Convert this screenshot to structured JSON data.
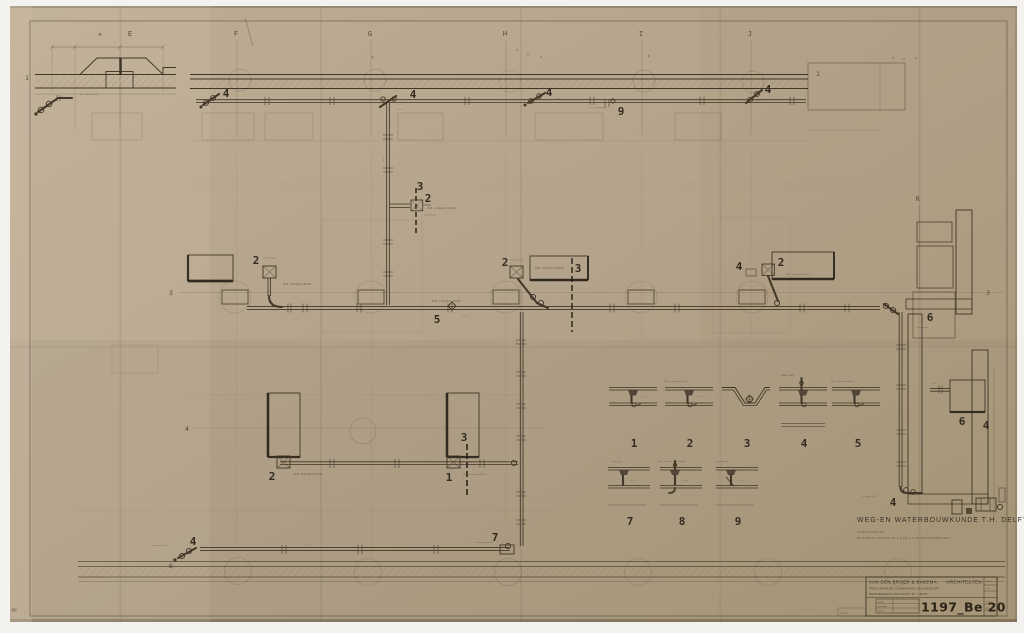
{
  "grid": {
    "letters": [
      "e",
      "E",
      "F",
      "G",
      "H",
      "I",
      "J"
    ],
    "letter_k": "K",
    "markers": {
      "top_left": "1",
      "top_right": "1",
      "row3_left": "3",
      "row3_right": "3",
      "row4_left": "4",
      "row6_left": "6"
    }
  },
  "callouts": {
    "one": "1",
    "two": "2",
    "three": "3",
    "four": "4",
    "five": "5",
    "six": "6",
    "seven": "7",
    "nine": "9"
  },
  "annotations": {
    "schrobput": "W.B. schrobput 30x30",
    "doucheput": "doucheput",
    "afv_asbest": "afv. asbest ø 100",
    "afv_geul": "afv. geul ø 100",
    "omlegging": "ø 75 omlegging",
    "ontstop": "met ontstopstuk",
    "afv_goot": "afv. goot ø 70",
    "dia70": "ø 70",
    "dia75": "ø 75"
  },
  "details_row1": [
    {
      "no": "1",
      "caption": ""
    },
    {
      "no": "2",
      "caption": "W.B. schrobput 30x30"
    },
    {
      "no": "3",
      "caption": ""
    },
    {
      "no": "4",
      "caption": "vloer goot"
    },
    {
      "no": "5",
      "caption": "W.B. schrobput 30x30"
    }
  ],
  "details_row2": [
    {
      "no": "7",
      "caption": "vloer put"
    },
    {
      "no": "8",
      "caption": "vloer put met 1\" standpijp"
    },
    {
      "no": "9",
      "caption": "ontstopstuk"
    }
  ],
  "title": {
    "main": "WEG-EN WATERBOUWKUNDE T.H. DELFT",
    "sub1": "HOOFDGEBOUW",
    "sub2": "RIOLERING TUSSEN AS 1-2 EN K-2  KRUIPRUIMTENIVEAU"
  },
  "titleblock": {
    "firm": "VAN DEN BROEK & BAKEMA",
    "firm_right": "ARCHITECTEN",
    "line2": "PROCURATIE EN COORDINATIE  J.B.RIJNSDORP",
    "line3": "MEDEWERKEND ARCHITECT  W. J. BOOT",
    "number": "1197_Be 20",
    "fields": [
      "datum",
      "gewijzigd",
      "gezien"
    ],
    "side_rows": [
      "schaal",
      "1:50",
      "1:100",
      "blad"
    ],
    "corner_note": "formaat"
  }
}
